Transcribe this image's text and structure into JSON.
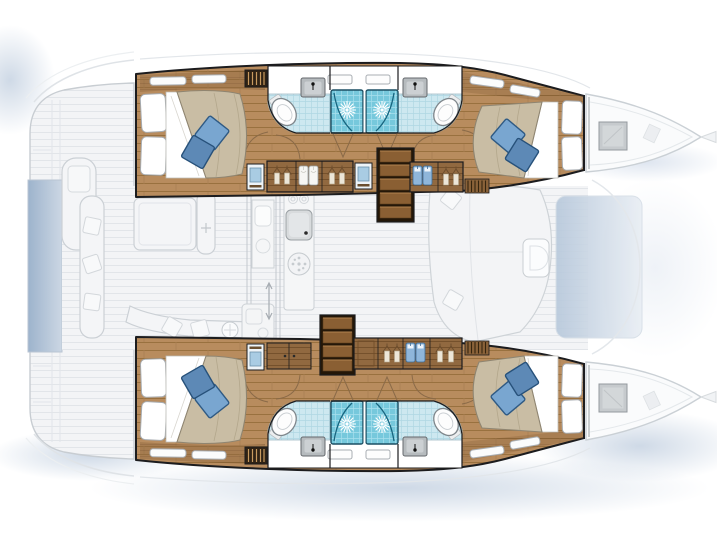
{
  "page": {
    "title": "Catamaran yacht accommodation layout plan",
    "background": "#ffffff"
  },
  "palette": {
    "outline": "#1c1c1e",
    "ghost_stroke": "#cbd0d5",
    "ghost_fill": "#f3f4f6",
    "ghost_line": "#e2e5e9",
    "wood_floor": "#b88c5e",
    "wood_floor_line": "#99713f",
    "wood_floor_joint": "#a87f52",
    "wood_dark": "#916940",
    "wood_dark_line": "#75512c",
    "steps_base": "#2a1b0b",
    "steps_tread": "#8a5f33",
    "bath_tile": "#cde8f0",
    "bath_tile_line": "#afd7e3",
    "shower_base": "#76c8dc",
    "shower_grid": "#a8e0ee",
    "shower_frame": "#1c4f63",
    "bed_duvet": "#c9bda4",
    "bed_duvet_edge": "#8f8571",
    "pillow_white": "#ffffff",
    "pillow_blue_light": "#79a6d0",
    "pillow_blue_dark": "#5d89b6",
    "pillow_blue_edge": "#2f5a84",
    "sink_gray": "#b6bbbe",
    "fixture_stroke": "#7f868b",
    "hatch_gray": "#c6cacd",
    "wash_blue": "#aec0d6",
    "platform_blue_1": "#9db3cc",
    "platform_blue_2": "#ccd7e4",
    "forward_wash_1": "#b7c8db",
    "forward_wash_2": "#e9eef4",
    "door_arc": "#8a6a48",
    "garment_blue": "#8fb6da",
    "cabinet_blue": "#a9cce3"
  },
  "diagram": {
    "type": "floorplan",
    "subject": "Catamaran sailing yacht — 4-cabin accommodation deck plan",
    "view": "top-down",
    "bow_direction": "right",
    "style": "hull interiors rendered in color; main deck, cockpit and bows shown ghosted in light gray",
    "counts": {
      "cabins": 4,
      "double_berths": 4,
      "bathrooms": 4,
      "showers": 4,
      "toilets": 4,
      "washbasins": 4,
      "companionway_steps": 2,
      "bow_deck_hatches": 2
    },
    "hulls": [
      {
        "name": "upper hull",
        "rooms": [
          {
            "name": "aft cabin",
            "items": [
              "double berth",
              "two white pillows",
              "two blue throw pillows",
              "hull windows",
              "shelf"
            ]
          },
          {
            "name": "aft bathroom",
            "items": [
              "toilet",
              "washbasin",
              "shower cabin with glass door"
            ]
          },
          {
            "name": "forward bathroom",
            "items": [
              "toilet",
              "washbasin",
              "shower cabin with glass door"
            ]
          },
          {
            "name": "forward cabin",
            "items": [
              "double berth",
              "two white pillows",
              "two blue throw pillows",
              "hull windows"
            ]
          },
          {
            "name": "companionway corridor",
            "items": [
              "steps to saloon",
              "hanging lockers with clothes",
              "blue-front cabinets",
              "louvered locker",
              "slatted grate"
            ]
          }
        ]
      },
      {
        "name": "lower hull",
        "rooms": [
          {
            "name": "aft cabin",
            "items": [
              "double berth",
              "two white pillows",
              "two blue throw pillows",
              "hull windows",
              "shelf"
            ]
          },
          {
            "name": "aft bathroom",
            "items": [
              "toilet",
              "washbasin",
              "shower cabin with glass door"
            ]
          },
          {
            "name": "forward bathroom",
            "items": [
              "toilet",
              "washbasin",
              "shower cabin with glass door"
            ]
          },
          {
            "name": "forward cabin",
            "items": [
              "double berth",
              "two white pillows",
              "two blue throw pillows",
              "hull windows"
            ]
          },
          {
            "name": "companionway corridor",
            "items": [
              "steps to saloon",
              "two-door cabinet",
              "hanging lockers with clothes",
              "blue-front cabinet",
              "louvered locker",
              "slatted grate"
            ]
          }
        ]
      }
    ],
    "main_deck_ghosted": {
      "areas": [
        "stern swim platforms",
        "tender platform (blue shaded)",
        "aft cockpit with table and benches",
        "helm seat",
        "saloon",
        "galley island with sink and stove burner",
        "wet bar",
        "forward lounge seating with table",
        "forward cockpit (blue shaded)",
        "foredeck and bow lockers with gray deck hatches",
        "bow tips"
      ]
    }
  }
}
